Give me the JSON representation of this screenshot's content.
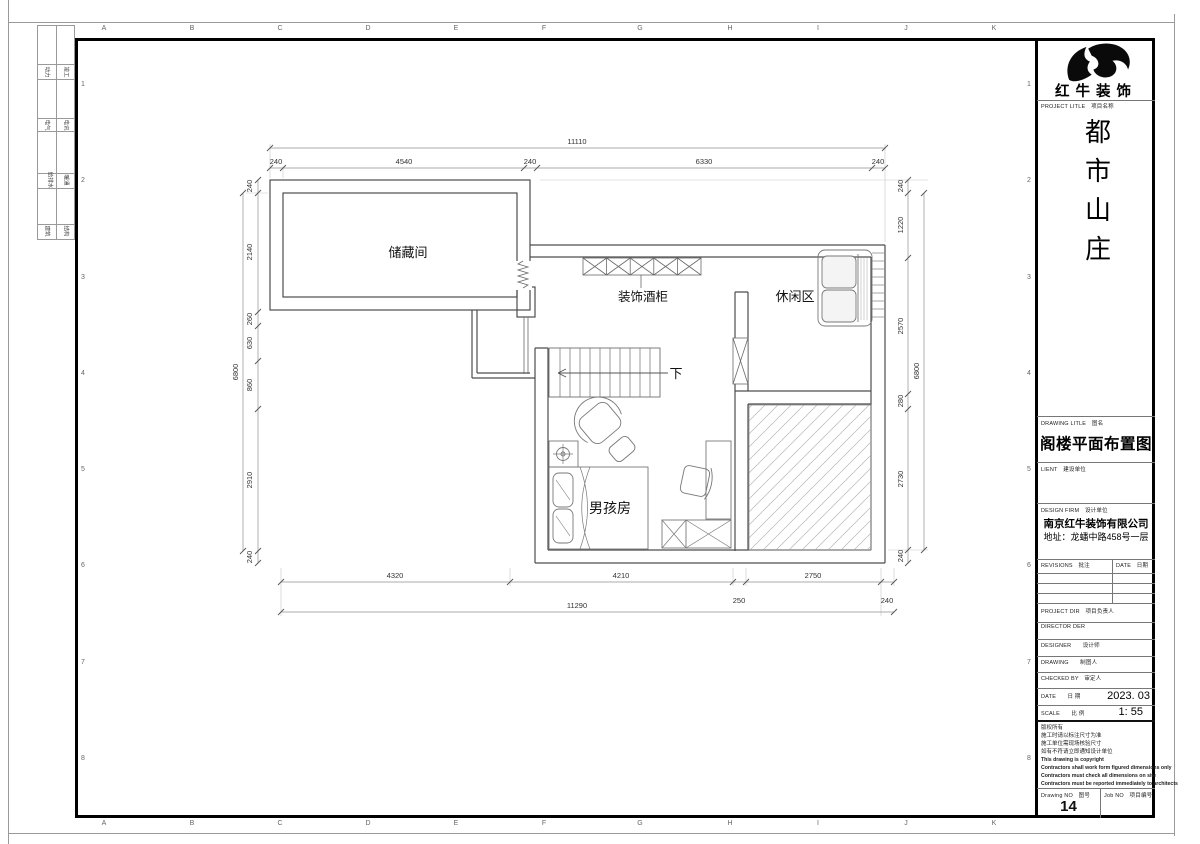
{
  "sheet": {
    "grid_letters": [
      "A",
      "B",
      "C",
      "D",
      "E",
      "F",
      "G",
      "H",
      "I",
      "J",
      "K"
    ],
    "grid_numbers": [
      "1",
      "2",
      "3",
      "4",
      "5",
      "6",
      "7",
      "8"
    ],
    "disciplines": [
      [
        "动力",
        "竣工"
      ],
      [
        "电气",
        "电讯"
      ],
      [
        "给排水",
        "暖通"
      ],
      [
        "建筑",
        "结构"
      ]
    ]
  },
  "plan": {
    "labels": {
      "storage": "储藏间",
      "wine_cabinet": "装饰酒柜",
      "leisure": "休闲区",
      "boy_room": "男孩房",
      "stairs_down": "下"
    },
    "dims": {
      "top_total": "11110",
      "top": [
        "240",
        "4540",
        "240",
        "6330",
        "240"
      ],
      "left_total": "6800",
      "left": [
        "240",
        "2140",
        "260",
        "630",
        "860",
        "2910",
        "240"
      ],
      "right_total": "6800",
      "right": [
        "240",
        "1220",
        "2570",
        "280",
        "2730",
        "240"
      ],
      "bottom_total": "11290",
      "bottom": [
        "4320",
        "4210",
        "2750"
      ],
      "bottom_sub": [
        "250",
        "240"
      ]
    }
  },
  "titleblock": {
    "brand": "红牛装饰",
    "project_label": "PROJECT LITLE　项目名称",
    "project_name": "都市山庄",
    "drawing_label": "DRAWING LITLE　图名",
    "drawing_title": "阁楼平面布置图",
    "client_label": "LIENT　建设单位",
    "firm_label": "DESIGN FIRM　设计单位",
    "firm_name": "南京红牛装饰有限公司",
    "firm_address": "地址：龙蟠中路458号一层",
    "revisions_label": "REVISIONS　批注",
    "rev_date_label": "DATE　日期",
    "project_dir_label": "PROJECT DIR　项目负责人",
    "director_label": "DIRECTOR DER",
    "designer_label": "DESIGNER　　设计师",
    "drawing_by_label": "DRAWING　　制图人",
    "checked_label": "CHECKED BY　审定人",
    "date_label": "DATE　　日  期",
    "date_value": "2023. 03",
    "scale_label": "SCALE　　比  例",
    "scale_value": "1:  55",
    "notes": [
      "版权所有",
      "施工时请以标注尺寸为准",
      "施工单位需现场核验尺寸",
      "如有不符请立即通知设计单位",
      "This drawing is copyright",
      "Contractors shall work form figured dimensions only",
      "Contractors must check all dimensions on site",
      "Contractors must be reported immediately to architects"
    ],
    "drawing_no_label": "Drawing NO　图号",
    "drawing_no": "14",
    "job_no_label": "Job NO　项目编号"
  }
}
